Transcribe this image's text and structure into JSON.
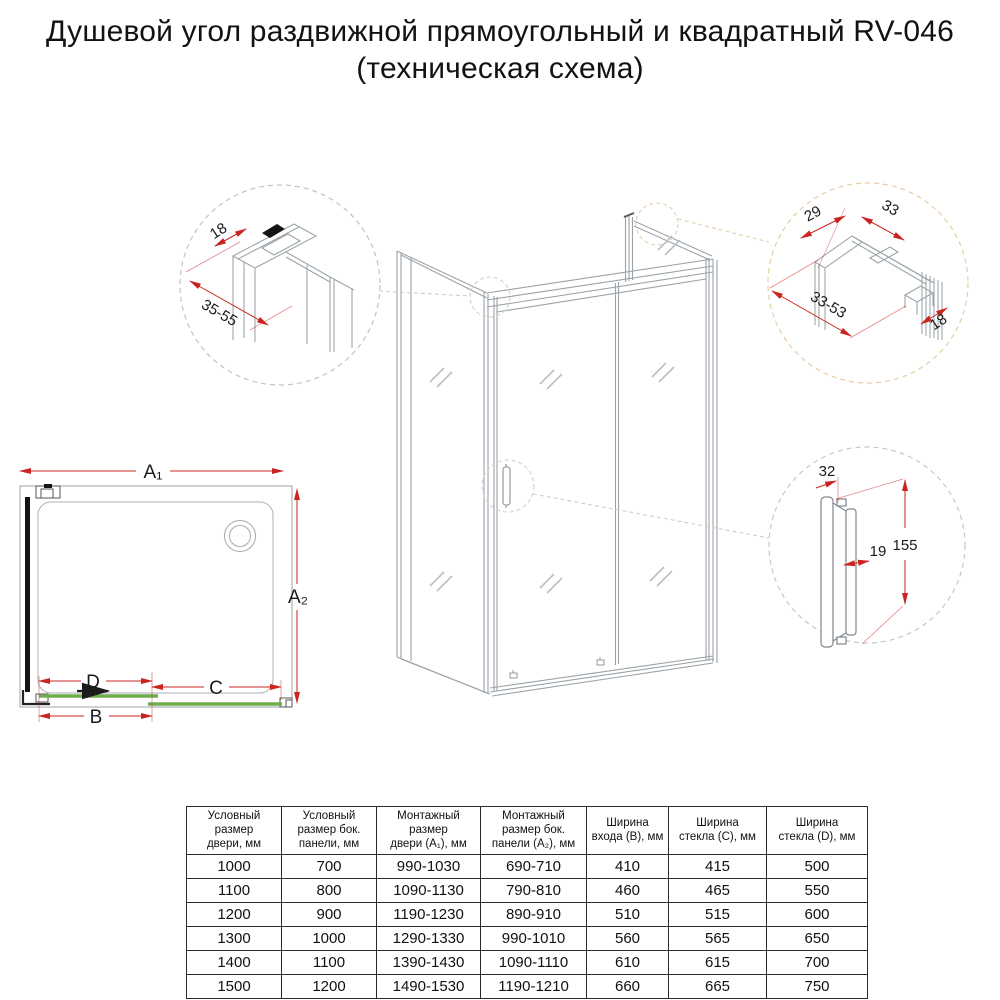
{
  "title": {
    "line1": "Душевой угол раздвижной прямоугольный и квадратный RV-046",
    "line2": "(техническая схема)"
  },
  "product_code": "RV-046",
  "colors": {
    "dimension_red": "#cb2420",
    "glass_green": "#6fae4e",
    "drawing_gray": "#9aa3a8",
    "detail_circle_green": "#b9c8bd",
    "detail_circle_orange": "#e7cda4",
    "detail_circle_gray": "#cccccc"
  },
  "plan": {
    "label_a1": "A₁",
    "label_a2": "A₂",
    "label_b": "B",
    "label_c": "C",
    "label_d": "D"
  },
  "detail_top_left": {
    "dim_18": "18",
    "dim_range": "35-55"
  },
  "detail_top_right": {
    "dim_29": "29",
    "dim_33": "33",
    "dim_range": "33-53",
    "dim_18": "18"
  },
  "detail_handle": {
    "dim_width": "32",
    "dim_height": "155",
    "dim_depth": "19"
  },
  "table": {
    "headers": [
      "Условный\nразмер\nдвери, мм",
      "Условный\nразмер бок.\nпанели, мм",
      "Монтажный\nразмер\nдвери (A₁), мм",
      "Монтажный\nразмер бок.\nпанели (A₂), мм",
      "Ширина\nвхода (B), мм",
      "Ширина\nстекла (C), мм",
      "Ширина\nстекла (D), мм"
    ],
    "rows": [
      [
        "1000",
        "700",
        "990-1030",
        "690-710",
        "410",
        "415",
        "500"
      ],
      [
        "1100",
        "800",
        "1090-1130",
        "790-810",
        "460",
        "465",
        "550"
      ],
      [
        "1200",
        "900",
        "1190-1230",
        "890-910",
        "510",
        "515",
        "600"
      ],
      [
        "1300",
        "1000",
        "1290-1330",
        "990-1010",
        "560",
        "565",
        "650"
      ],
      [
        "1400",
        "1100",
        "1390-1430",
        "1090-1110",
        "610",
        "615",
        "700"
      ],
      [
        "1500",
        "1200",
        "1490-1530",
        "1190-1210",
        "660",
        "665",
        "750"
      ]
    ]
  }
}
